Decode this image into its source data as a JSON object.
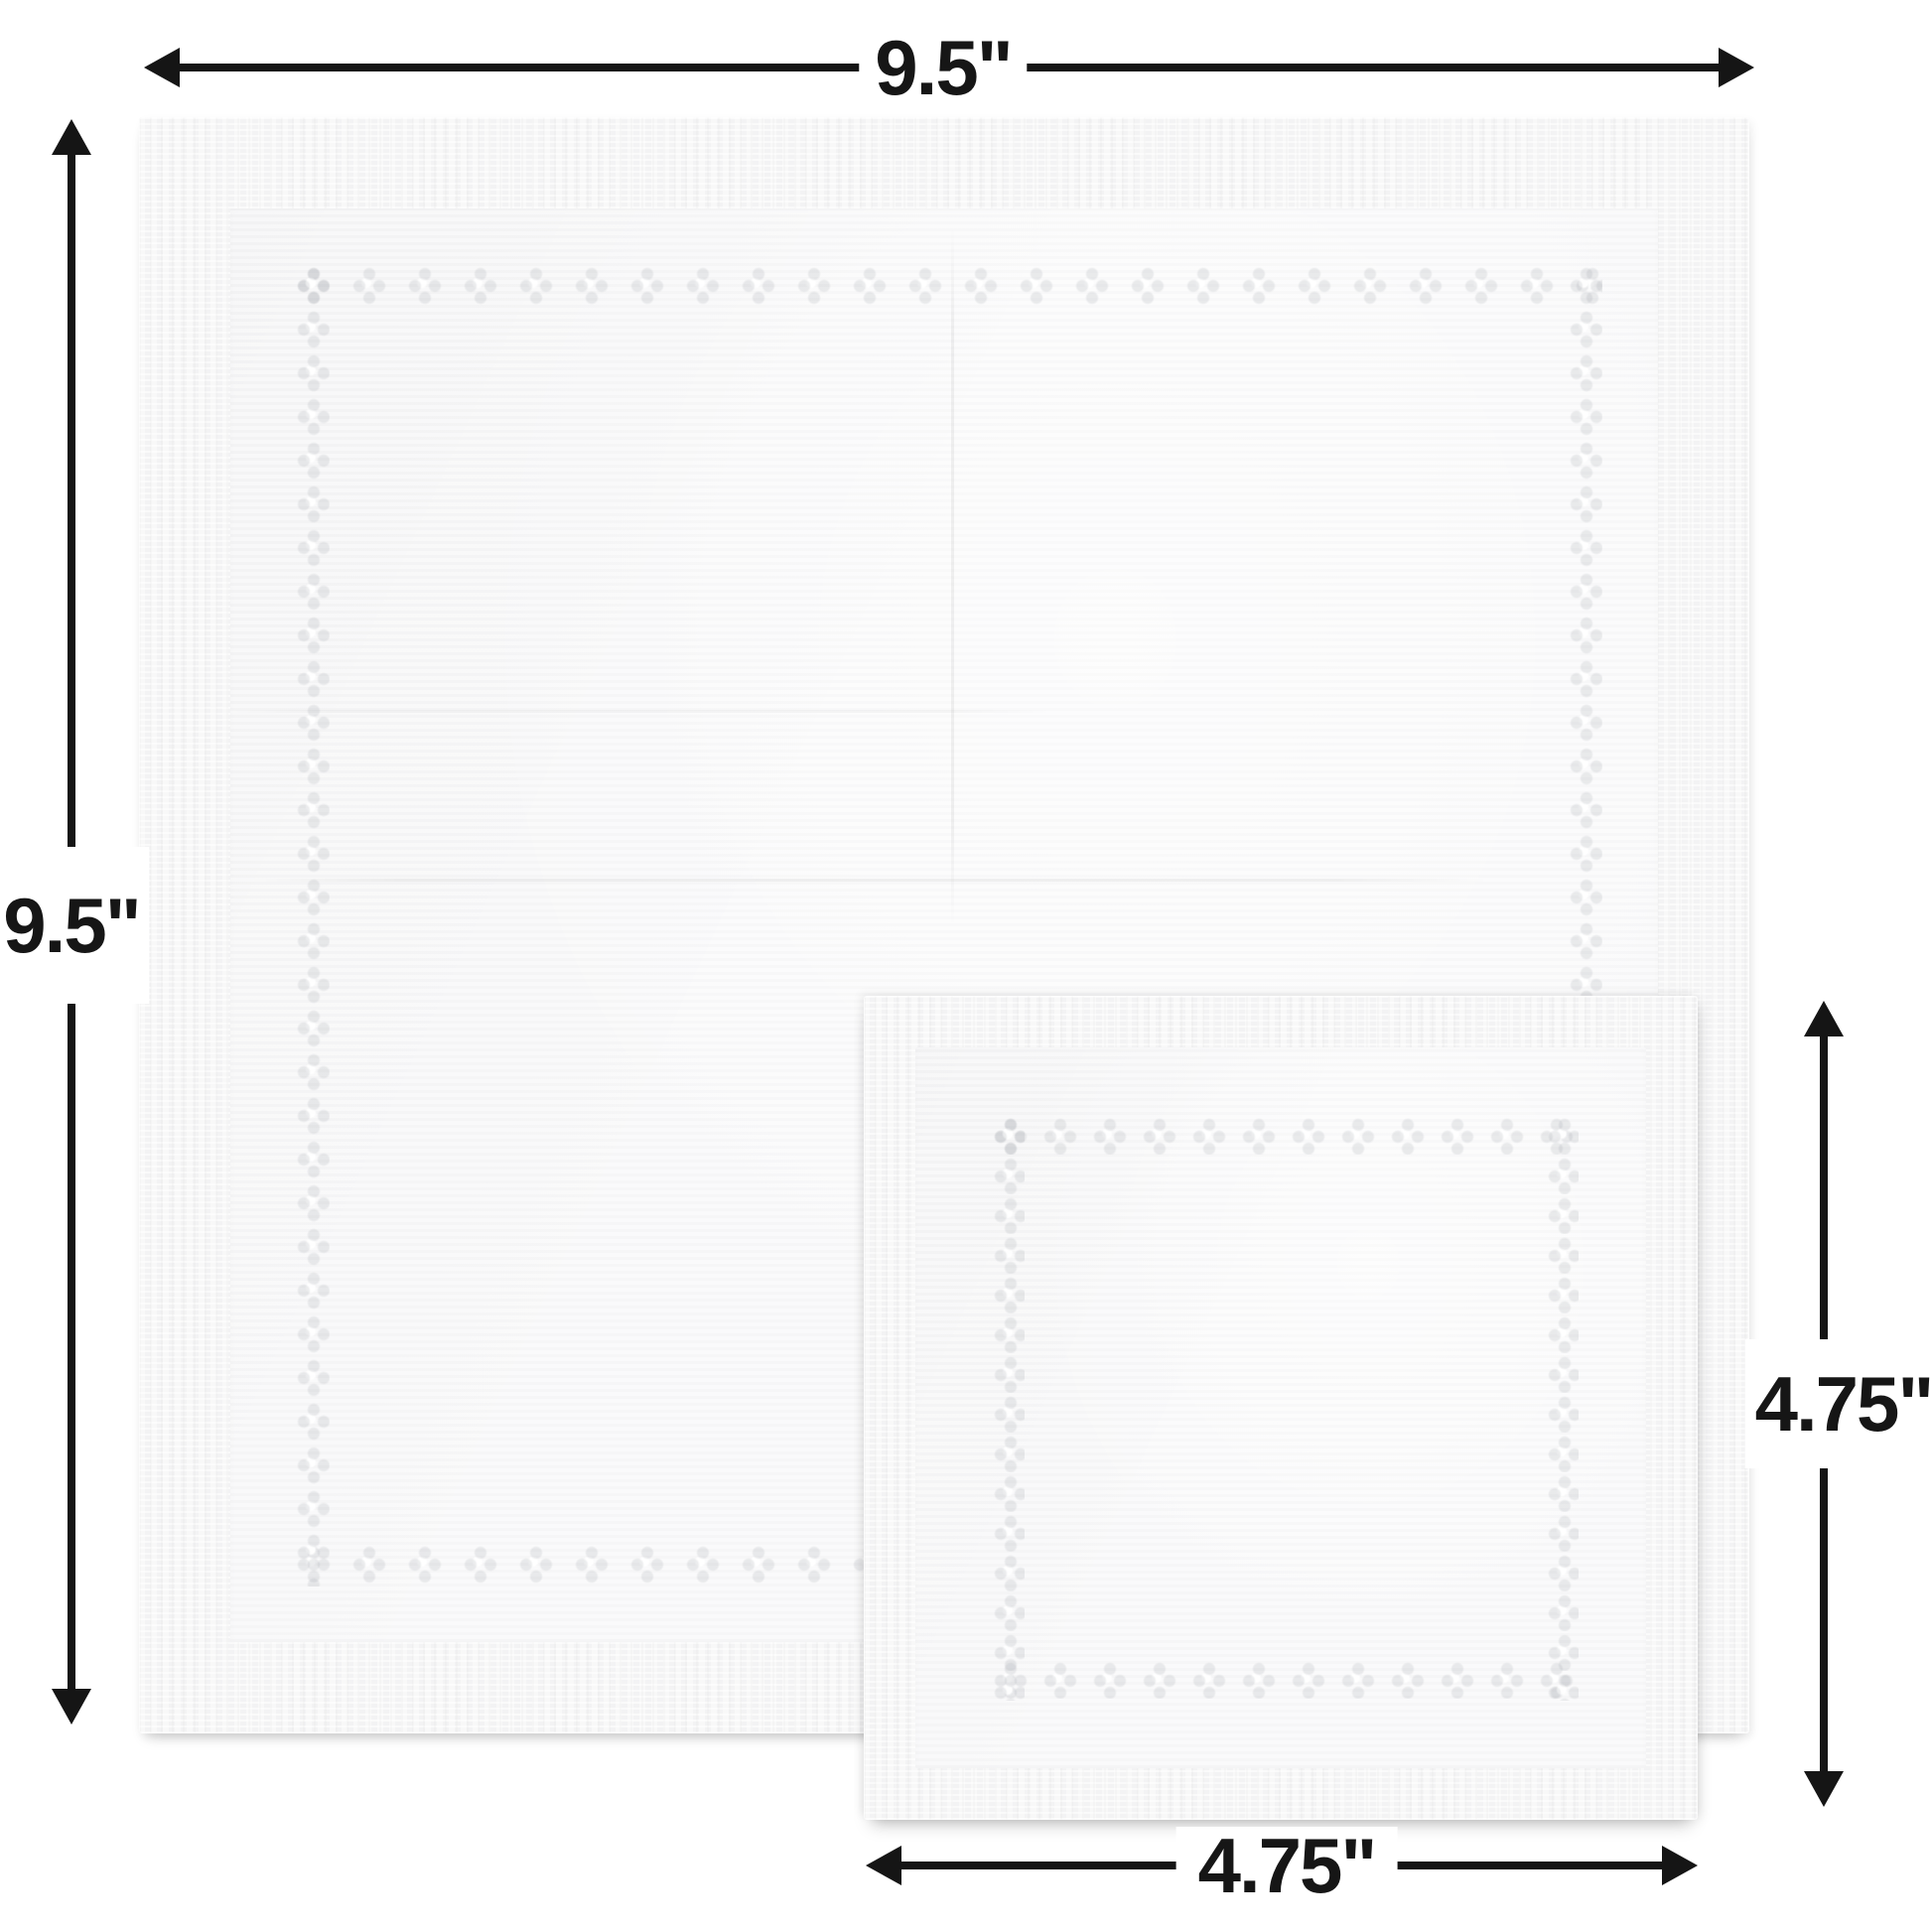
{
  "measurements": {
    "large_width": {
      "label": "9.5\"",
      "orientation": "horizontal",
      "applies_to": "large-napkin"
    },
    "large_height": {
      "label": "9.5\"",
      "orientation": "vertical",
      "applies_to": "large-napkin"
    },
    "small_height": {
      "label": "4.75\"",
      "orientation": "vertical",
      "applies_to": "small-napkin"
    },
    "small_width": {
      "label": "4.75\"",
      "orientation": "horizontal",
      "applies_to": "small-napkin"
    }
  },
  "objects": {
    "large_napkin": {
      "description_name": "large-napkin",
      "surface_color": "#f6f6f7"
    },
    "small_napkin": {
      "description_name": "small-napkin",
      "surface_color": "#f6f6f7"
    }
  },
  "icons": [
    "arrowhead-left-icon",
    "arrowhead-right-icon",
    "arrowhead-up-icon",
    "arrowhead-down-icon"
  ],
  "colors": {
    "background": "#ffffff",
    "arrow": "#151515",
    "label_text": "#161616",
    "napkin_base": "#f6f6f7",
    "napkin_field": "#f8f8f9"
  }
}
